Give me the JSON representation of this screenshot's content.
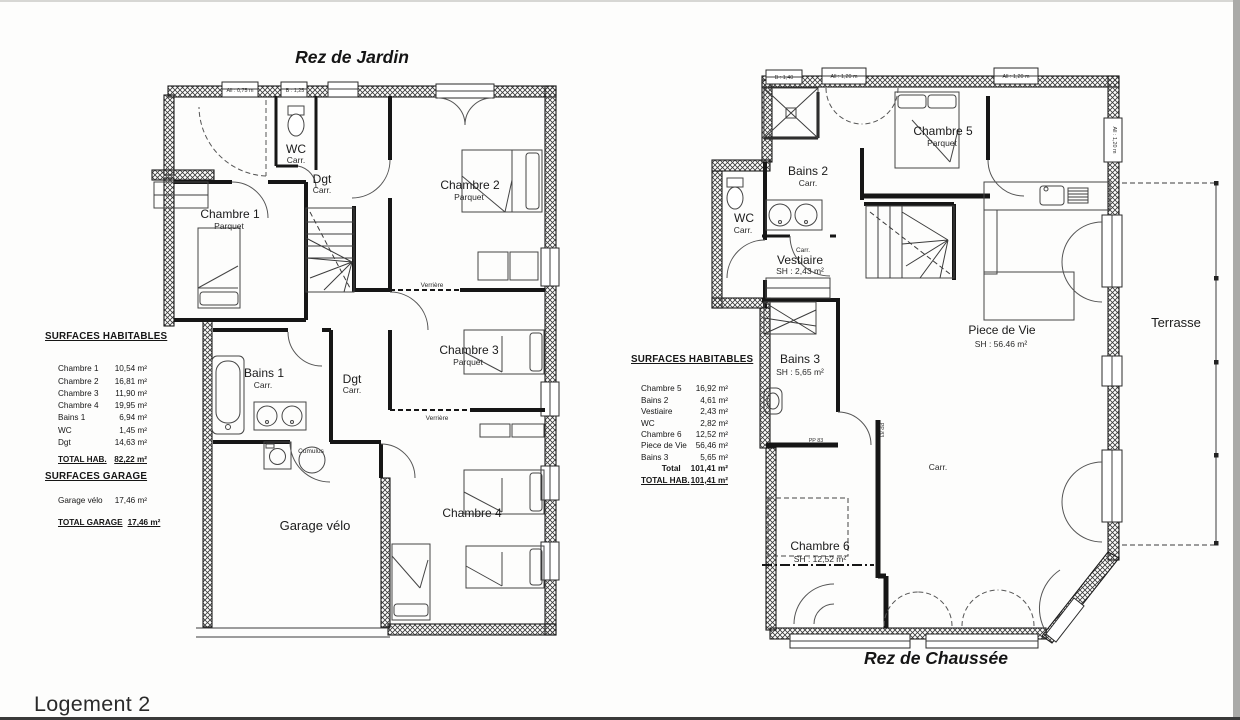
{
  "footer": {
    "label": "Logement 2"
  },
  "garden": {
    "title": "Rez de Jardin",
    "labels": {
      "wc": "WC",
      "wc_floor": "Carr.",
      "dgt1": "Dgt",
      "dgt1_floor": "Carr.",
      "c1": "Chambre 1",
      "c1_floor": "Parquet",
      "c2": "Chambre 2",
      "c2_floor": "Parquet",
      "c3": "Chambre 3",
      "c3_floor": "Parquet",
      "c4": "Chambre 4",
      "bains1": "Bains 1",
      "bains1_floor": "Carr.",
      "dgt2": "Dgt",
      "dgt2_floor": "Carr.",
      "garage": "Garage vélo",
      "cumulus": "Cumulus",
      "verriere1": "Verrière",
      "verriere2": "Verrière",
      "win1": "All : 0,75 m",
      "win2": "B : 1,25"
    },
    "table": {
      "heading": "SURFACES HABITABLES",
      "rows": [
        {
          "label": "Chambre 1",
          "value": "10,54 m²"
        },
        {
          "label": "Chambre 2",
          "value": "16,81 m²"
        },
        {
          "label": "Chambre 3",
          "value": "11,90 m²"
        },
        {
          "label": "Chambre 4",
          "value": "19,95 m²"
        },
        {
          "label": "Bains 1",
          "value": "6,94 m²"
        },
        {
          "label": "WC",
          "value": "1,45 m²"
        },
        {
          "label": "Dgt",
          "value": "14,63 m²"
        }
      ],
      "total_label": "TOTAL HAB.",
      "total_value": "82,22 m²",
      "garage_heading": "SURFACES GARAGE",
      "garage_row": {
        "label": "Garage vélo",
        "value": "17,46 m²"
      },
      "garage_total_label": "TOTAL GARAGE",
      "garage_total_value": "17,46 m²"
    }
  },
  "ground": {
    "title": "Rez de Chaussée",
    "labels": {
      "bains2": "Bains 2",
      "bains2_floor": "Carr.",
      "wc": "WC",
      "wc_floor": "Carr.",
      "c5": "Chambre 5",
      "c5_floor": "Parquet",
      "vest_floor": "Carr.",
      "vest": "Vestiaire",
      "vest_sh": "SH : 2,43 m²",
      "bains3": "Bains 3",
      "bains3_sh": "SH : 5,65 m²",
      "piece": "Piece de Vie",
      "piece_sh": "SH : 56.46 m²",
      "c6": "Chambre 6",
      "c6_sh": "SH : 12,52 m²",
      "hall_floor": "Carr.",
      "terrasse": "Terrasse",
      "win1": "B : 1,40",
      "win2": "All : 1,20 m",
      "win3": "All : 1,20 m",
      "win4": "All : 1,20 m",
      "pp83a": "PP 83",
      "pp83b": "PP 83"
    },
    "table": {
      "heading": "SURFACES HABITABLES",
      "rows": [
        {
          "label": "Chambre 5",
          "value": "16,92 m²"
        },
        {
          "label": "Bains 2",
          "value": "4,61 m²"
        },
        {
          "label": "Vestiaire",
          "value": "2,43 m²"
        },
        {
          "label": "WC",
          "value": "2,82 m²"
        },
        {
          "label": "Chambre 6",
          "value": "12,52 m²"
        },
        {
          "label": "Piece de Vie",
          "value": "56,46 m²"
        },
        {
          "label": "Bains 3",
          "value": "5,65 m²"
        }
      ],
      "subtotal_label": "Total",
      "subtotal_value": "101,41 m²",
      "total_label": "TOTAL HAB.",
      "total_value": "101,41 m²"
    }
  }
}
